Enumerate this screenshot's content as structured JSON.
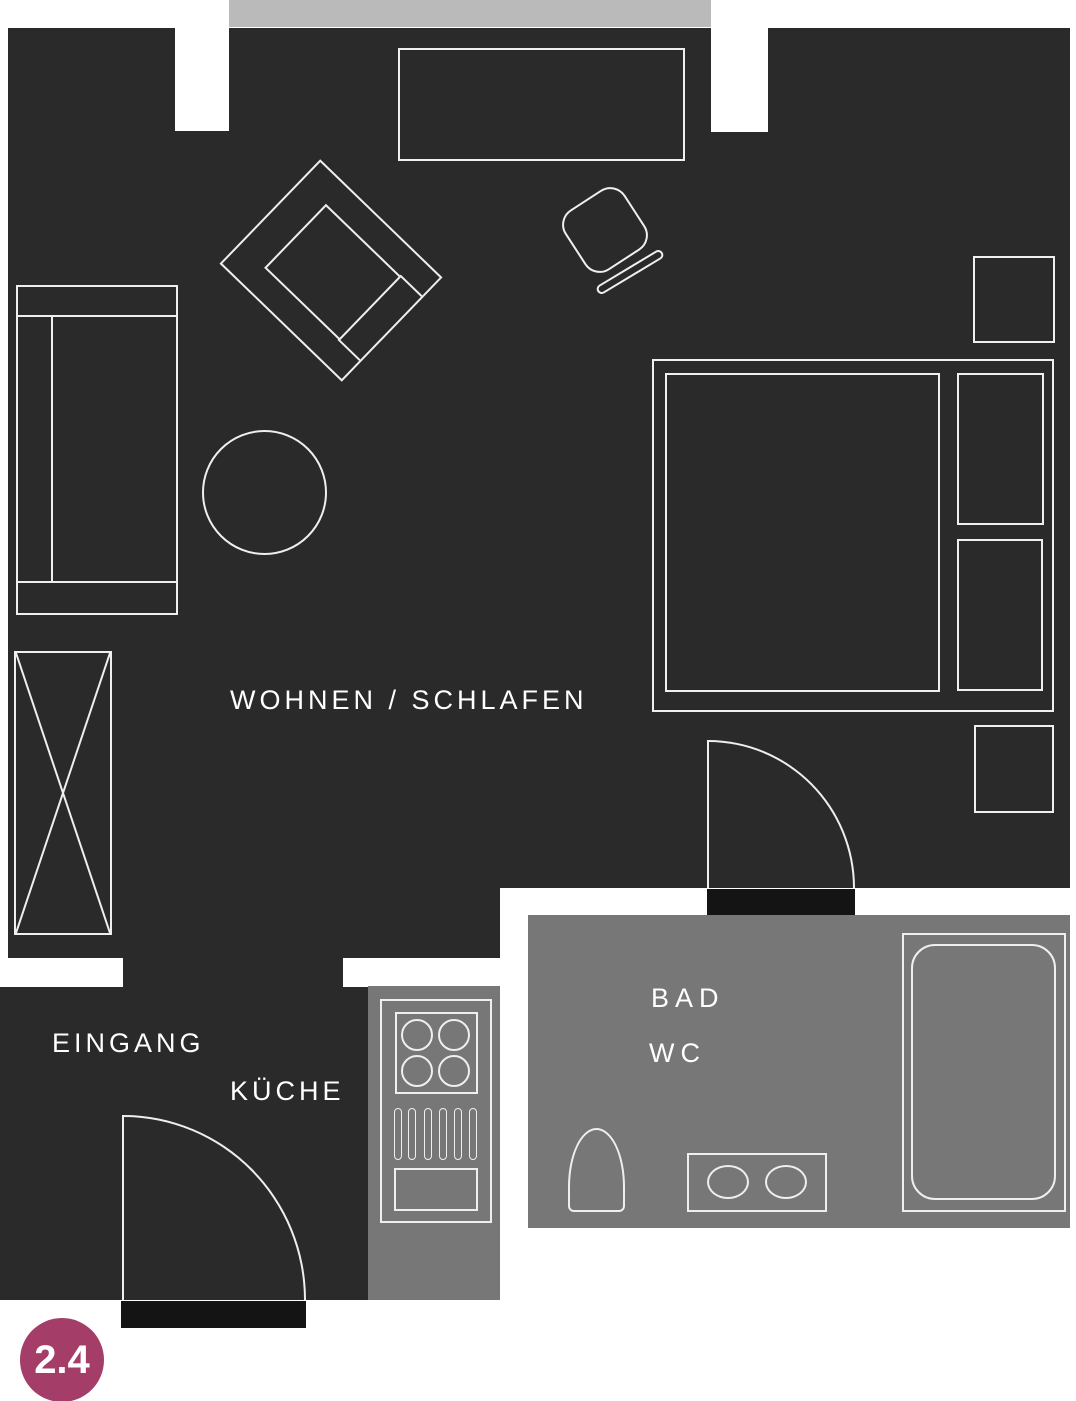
{
  "plan": {
    "type": "apartment-floor-plan",
    "unit_number": "2.4",
    "labels": {
      "living": "WOHNEN / SCHLAFEN",
      "entrance": "EINGANG",
      "kitchen": "KÜCHE",
      "bath": "BAD",
      "wc": "WC"
    },
    "rooms": [
      {
        "name": "living-sleeping",
        "label": "WOHNEN / SCHLAFEN",
        "fill": "#2a2a2a"
      },
      {
        "name": "entrance",
        "label": "EINGANG",
        "fill": "#2a2a2a"
      },
      {
        "name": "kitchen",
        "label": "KÜCHE",
        "fill": "#777777"
      },
      {
        "name": "bathroom",
        "label": "BAD WC",
        "fill": "#777777"
      },
      {
        "name": "balcony-strip",
        "label": "",
        "fill": "#bababa"
      }
    ],
    "furniture": [
      "sideboard",
      "armchair",
      "desk-chair",
      "chair-bar",
      "sofa",
      "round-table",
      "wardrobe",
      "bed-frame",
      "mattress",
      "pillow",
      "pillow",
      "nightstand",
      "nightstand",
      "interior-door",
      "entrance-door",
      "kitchen-counter",
      "hob-4-burners",
      "vent-grille",
      "kitchen-drawer",
      "toilet",
      "vanity-two-basins",
      "bathtub"
    ],
    "colors": {
      "room_dark": "#2a2a2a",
      "wet_room_gray": "#777777",
      "balcony_gray": "#bababa",
      "threshold_black": "#141414",
      "outline_white": "#efefef",
      "badge_pink": "#a43d67",
      "label_text": "#ffffff",
      "background": "#ffffff"
    }
  },
  "badge": {
    "label": "2.4"
  }
}
